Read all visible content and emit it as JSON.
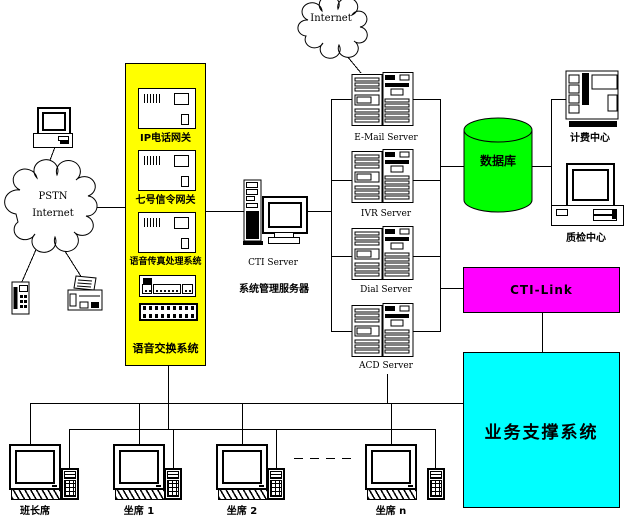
{
  "palette": {
    "background": "#ffffff",
    "line": "#000000",
    "voice_platform_bg": "#ffff00",
    "database_fill": "#00ff00",
    "cti_link_bg": "#ff00ff",
    "business_support_bg": "#00ffff"
  },
  "clouds": {
    "internet": {
      "label": "Internet"
    },
    "pstn": {
      "line1": "PSTN",
      "line2": "Internet"
    }
  },
  "voice_platform": {
    "label": "语音交换系统",
    "gateways": [
      {
        "label": "IP电话网关"
      },
      {
        "label": "七号信令网关"
      },
      {
        "label": "语音传真处理系统"
      }
    ]
  },
  "cti_server": {
    "line1": "CTI Server",
    "line2": "系统管理服务器"
  },
  "servers": [
    {
      "label": "E-Mail Server"
    },
    {
      "label": "IVR Server"
    },
    {
      "label": "Dial Server"
    },
    {
      "label": "ACD Server"
    }
  ],
  "database": {
    "label": "数据库"
  },
  "billing_center": {
    "label": "计费中心"
  },
  "qc_center": {
    "label": "质检中心"
  },
  "cti_link": {
    "label": "CTI-Link"
  },
  "business_support": {
    "label": "业务支撑系统"
  },
  "agents": [
    {
      "label": "班长席"
    },
    {
      "label": "坐席 1"
    },
    {
      "label": "坐席 2"
    },
    {
      "label": "坐席 n"
    }
  ]
}
